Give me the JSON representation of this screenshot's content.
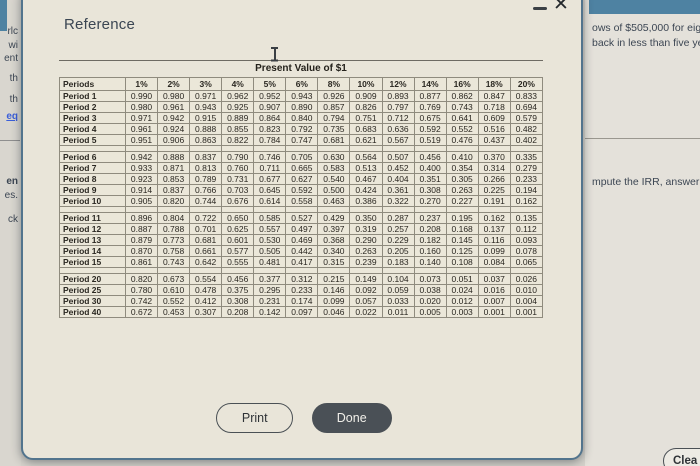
{
  "dialog": {
    "title": "Reference",
    "close_icon": "✕",
    "table_title": "Present Value of $1",
    "print_label": "Print",
    "done_label": "Done"
  },
  "table": {
    "header": [
      "Periods",
      "1%",
      "2%",
      "3%",
      "4%",
      "5%",
      "6%",
      "8%",
      "10%",
      "12%",
      "14%",
      "16%",
      "18%",
      "20%"
    ],
    "groups": [
      [
        {
          "label": "Period 1",
          "values": [
            "0.990",
            "0.980",
            "0.971",
            "0.962",
            "0.952",
            "0.943",
            "0.926",
            "0.909",
            "0.893",
            "0.877",
            "0.862",
            "0.847",
            "0.833"
          ]
        },
        {
          "label": "Period 2",
          "values": [
            "0.980",
            "0.961",
            "0.943",
            "0.925",
            "0.907",
            "0.890",
            "0.857",
            "0.826",
            "0.797",
            "0.769",
            "0.743",
            "0.718",
            "0.694"
          ]
        },
        {
          "label": "Period 3",
          "values": [
            "0.971",
            "0.942",
            "0.915",
            "0.889",
            "0.864",
            "0.840",
            "0.794",
            "0.751",
            "0.712",
            "0.675",
            "0.641",
            "0.609",
            "0.579"
          ]
        },
        {
          "label": "Period 4",
          "values": [
            "0.961",
            "0.924",
            "0.888",
            "0.855",
            "0.823",
            "0.792",
            "0.735",
            "0.683",
            "0.636",
            "0.592",
            "0.552",
            "0.516",
            "0.482"
          ]
        },
        {
          "label": "Period 5",
          "values": [
            "0.951",
            "0.906",
            "0.863",
            "0.822",
            "0.784",
            "0.747",
            "0.681",
            "0.621",
            "0.567",
            "0.519",
            "0.476",
            "0.437",
            "0.402"
          ]
        }
      ],
      [
        {
          "label": "Period 6",
          "values": [
            "0.942",
            "0.888",
            "0.837",
            "0.790",
            "0.746",
            "0.705",
            "0.630",
            "0.564",
            "0.507",
            "0.456",
            "0.410",
            "0.370",
            "0.335"
          ]
        },
        {
          "label": "Period 7",
          "values": [
            "0.933",
            "0.871",
            "0.813",
            "0.760",
            "0.711",
            "0.665",
            "0.583",
            "0.513",
            "0.452",
            "0.400",
            "0.354",
            "0.314",
            "0.279"
          ]
        },
        {
          "label": "Period 8",
          "values": [
            "0.923",
            "0.853",
            "0.789",
            "0.731",
            "0.677",
            "0.627",
            "0.540",
            "0.467",
            "0.404",
            "0.351",
            "0.305",
            "0.266",
            "0.233"
          ]
        },
        {
          "label": "Period 9",
          "values": [
            "0.914",
            "0.837",
            "0.766",
            "0.703",
            "0.645",
            "0.592",
            "0.500",
            "0.424",
            "0.361",
            "0.308",
            "0.263",
            "0.225",
            "0.194"
          ]
        },
        {
          "label": "Period 10",
          "values": [
            "0.905",
            "0.820",
            "0.744",
            "0.676",
            "0.614",
            "0.558",
            "0.463",
            "0.386",
            "0.322",
            "0.270",
            "0.227",
            "0.191",
            "0.162"
          ]
        }
      ],
      [
        {
          "label": "Period 11",
          "values": [
            "0.896",
            "0.804",
            "0.722",
            "0.650",
            "0.585",
            "0.527",
            "0.429",
            "0.350",
            "0.287",
            "0.237",
            "0.195",
            "0.162",
            "0.135"
          ]
        },
        {
          "label": "Period 12",
          "values": [
            "0.887",
            "0.788",
            "0.701",
            "0.625",
            "0.557",
            "0.497",
            "0.397",
            "0.319",
            "0.257",
            "0.208",
            "0.168",
            "0.137",
            "0.112"
          ]
        },
        {
          "label": "Period 13",
          "values": [
            "0.879",
            "0.773",
            "0.681",
            "0.601",
            "0.530",
            "0.469",
            "0.368",
            "0.290",
            "0.229",
            "0.182",
            "0.145",
            "0.116",
            "0.093"
          ]
        },
        {
          "label": "Period 14",
          "values": [
            "0.870",
            "0.758",
            "0.661",
            "0.577",
            "0.505",
            "0.442",
            "0.340",
            "0.263",
            "0.205",
            "0.160",
            "0.125",
            "0.099",
            "0.078"
          ]
        },
        {
          "label": "Period 15",
          "values": [
            "0.861",
            "0.743",
            "0.642",
            "0.555",
            "0.481",
            "0.417",
            "0.315",
            "0.239",
            "0.183",
            "0.140",
            "0.108",
            "0.084",
            "0.065"
          ]
        }
      ],
      [
        {
          "label": "Period 20",
          "values": [
            "0.820",
            "0.673",
            "0.554",
            "0.456",
            "0.377",
            "0.312",
            "0.215",
            "0.149",
            "0.104",
            "0.073",
            "0.051",
            "0.037",
            "0.026"
          ]
        },
        {
          "label": "Period 25",
          "values": [
            "0.780",
            "0.610",
            "0.478",
            "0.375",
            "0.295",
            "0.233",
            "0.146",
            "0.092",
            "0.059",
            "0.038",
            "0.024",
            "0.016",
            "0.010"
          ]
        },
        {
          "label": "Period 30",
          "values": [
            "0.742",
            "0.552",
            "0.412",
            "0.308",
            "0.231",
            "0.174",
            "0.099",
            "0.057",
            "0.033",
            "0.020",
            "0.012",
            "0.007",
            "0.004"
          ]
        },
        {
          "label": "Period 40",
          "values": [
            "0.672",
            "0.453",
            "0.307",
            "0.208",
            "0.142",
            "0.097",
            "0.046",
            "0.022",
            "0.011",
            "0.005",
            "0.003",
            "0.001",
            "0.001"
          ]
        }
      ]
    ]
  },
  "background": {
    "left_fragments": [
      {
        "text": "rlc"
      },
      {
        "text": "wi"
      },
      {
        "text": "ent"
      },
      {
        "text": "th"
      },
      {
        "text": "th"
      },
      {
        "text": "eq"
      },
      {
        "text": "en"
      },
      {
        "text": "es."
      },
      {
        "text": "ck"
      }
    ],
    "right_lines_top": [
      "ows of $505,000 for eigh",
      "back in less than five yea"
    ],
    "right_line_bottom": "mpute the IRR, answer w",
    "partial_button_label": "Clea"
  },
  "colors": {
    "accent_teal": "#4e82a2",
    "dialog_bg": "#e9e5d9",
    "dialog_border": "#52748d",
    "done_button_bg": "#4a5056",
    "link_blue": "#3b5fd9"
  }
}
